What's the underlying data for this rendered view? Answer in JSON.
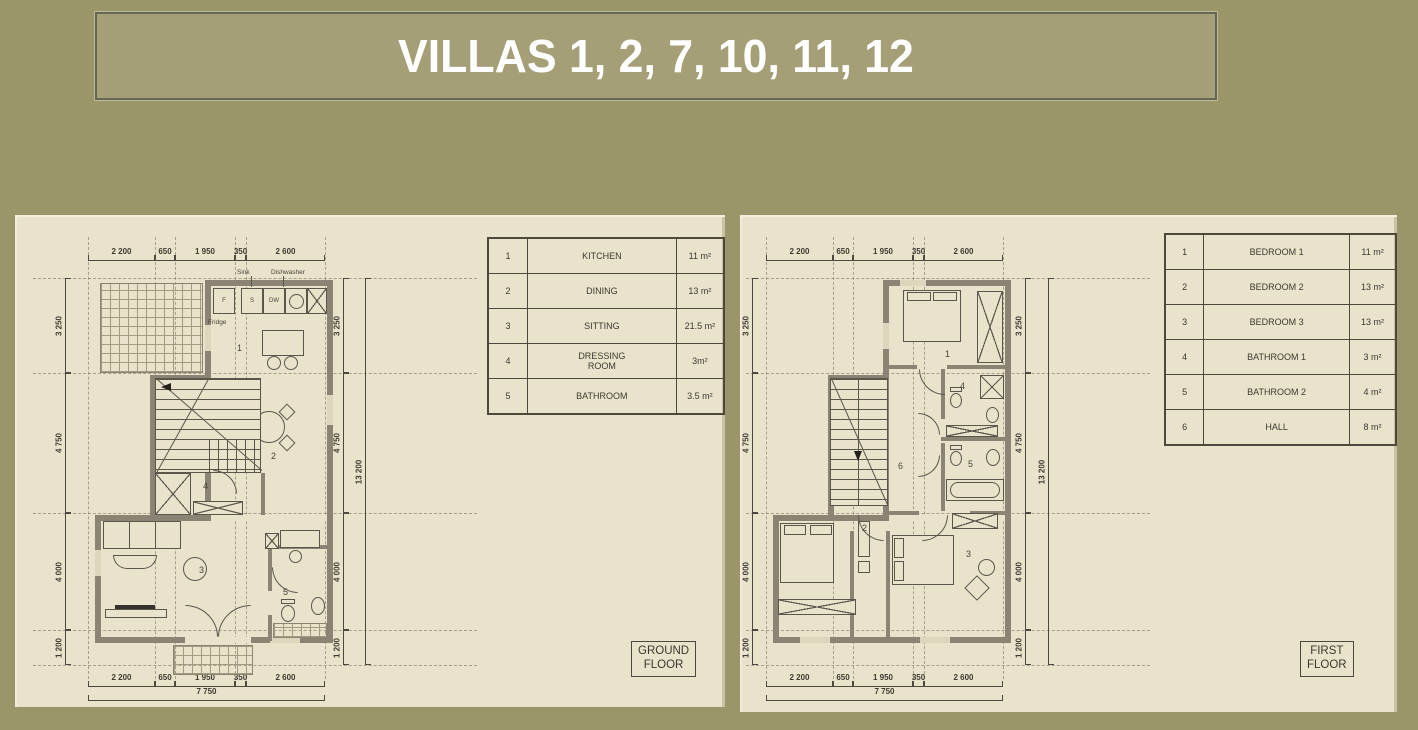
{
  "title": "VILLAS 1, 2, 7, 10, 11, 12",
  "colors": {
    "background": "#9a9669",
    "banner_fill": "#a49f76",
    "banner_border": "#66655a",
    "title_text": "#ffffff",
    "paper": "#e9e3cb",
    "wall": "#8b8374",
    "line": "#4c483e"
  },
  "ground_floor": {
    "floor_label_line1": "GROUND",
    "floor_label_line2": "FLOOR",
    "legend": [
      {
        "num": "1",
        "name": "KITCHEN",
        "area": "11 m²"
      },
      {
        "num": "2",
        "name": "DINING",
        "area": "13 m²"
      },
      {
        "num": "3",
        "name": "SITTING",
        "area": "21.5 m²"
      },
      {
        "num": "4",
        "name": "DRESSING ROOM",
        "area": "3m²"
      },
      {
        "num": "5",
        "name": "BATHROOM",
        "area": "3.5 m²"
      }
    ],
    "dims_horizontal": [
      "2 200",
      "650",
      "1 950",
      "350",
      "2 600"
    ],
    "dim_total_width": "7 750",
    "dims_vertical": [
      "3 250",
      "4 750",
      "4 000",
      "1 200"
    ],
    "dim_total_height": "13 200",
    "rooms": {
      "kitchen": "1",
      "dining": "2",
      "sitting": "3",
      "dressing": "4",
      "bathroom": "5"
    },
    "kitchen_labels": {
      "fridge_abbr": "F",
      "sink_abbr": "S",
      "dishwasher_abbr": "DW",
      "sink": "Sink",
      "dishwasher": "Dishwasher",
      "fridge": "Fridge"
    }
  },
  "first_floor": {
    "floor_label_line1": "FIRST",
    "floor_label_line2": "FLOOR",
    "legend": [
      {
        "num": "1",
        "name": "BEDROOM 1",
        "area": "11 m²"
      },
      {
        "num": "2",
        "name": "BEDROOM 2",
        "area": "13 m²"
      },
      {
        "num": "3",
        "name": "BEDROOM 3",
        "area": "13 m²"
      },
      {
        "num": "4",
        "name": "BATHROOM 1",
        "area": "3 m²"
      },
      {
        "num": "5",
        "name": "BATHROOM 2",
        "area": "4 m²"
      },
      {
        "num": "6",
        "name": "HALL",
        "area": "8 m²"
      }
    ],
    "dims_horizontal": [
      "2 200",
      "650",
      "1 950",
      "350",
      "2 600"
    ],
    "dim_total_width": "7 750",
    "dims_vertical": [
      "3 250",
      "4 750",
      "4 000",
      "1 200"
    ],
    "dim_total_height": "13 200",
    "rooms": {
      "bedroom1": "1",
      "bedroom2": "2",
      "bedroom3": "3",
      "bathroom1": "4",
      "bathroom2": "5",
      "hall": "6"
    }
  }
}
